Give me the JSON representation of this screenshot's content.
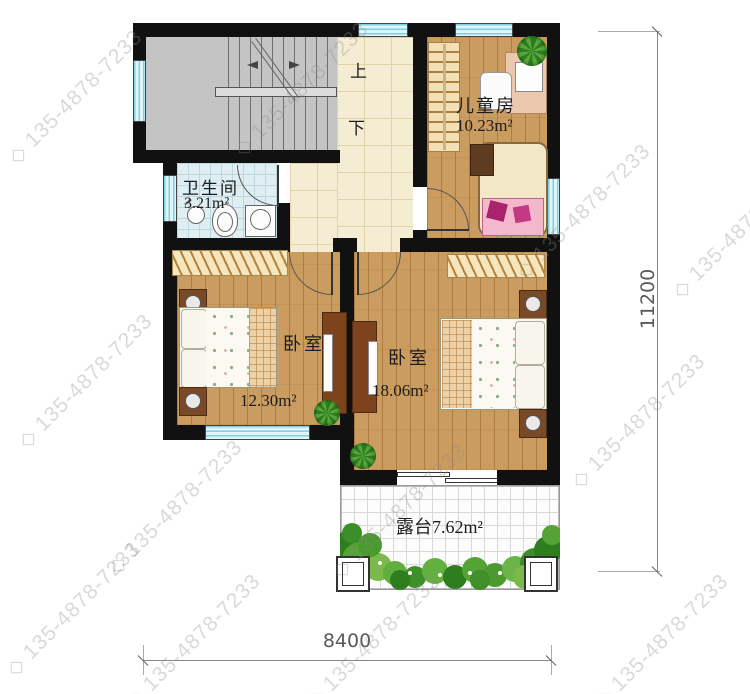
{
  "title": "second-floor-plan",
  "watermark": {
    "prefix": "◇",
    "text": "135-4878-7233"
  },
  "rooms": {
    "bathroom": {
      "name": "卫生间",
      "area": "3.21m²"
    },
    "kids_room": {
      "name": "儿童房",
      "area": "10.23m²"
    },
    "bedroom_left": {
      "name": "卧室",
      "area": "12.30m²"
    },
    "bedroom_right": {
      "name": "卧室",
      "area": "18.06m²"
    },
    "terrace": {
      "name": "露台",
      "area": "7.62m²"
    }
  },
  "stairs": {
    "up_label": "上",
    "down_label": "下"
  },
  "dimensions": {
    "width_label": "8400",
    "height_label": "11200"
  },
  "colors": {
    "wall": "#111111",
    "window": "#bfe9f4",
    "wood_floor": "#cb9c60",
    "tile_floor": "#f5edd3",
    "bath_floor": "#deeef2",
    "stair_floor": "#c4c4c4",
    "greenery": "#4f9e35",
    "dimension_text": "#5a5a5a",
    "watermark": "#8a8a8a"
  }
}
